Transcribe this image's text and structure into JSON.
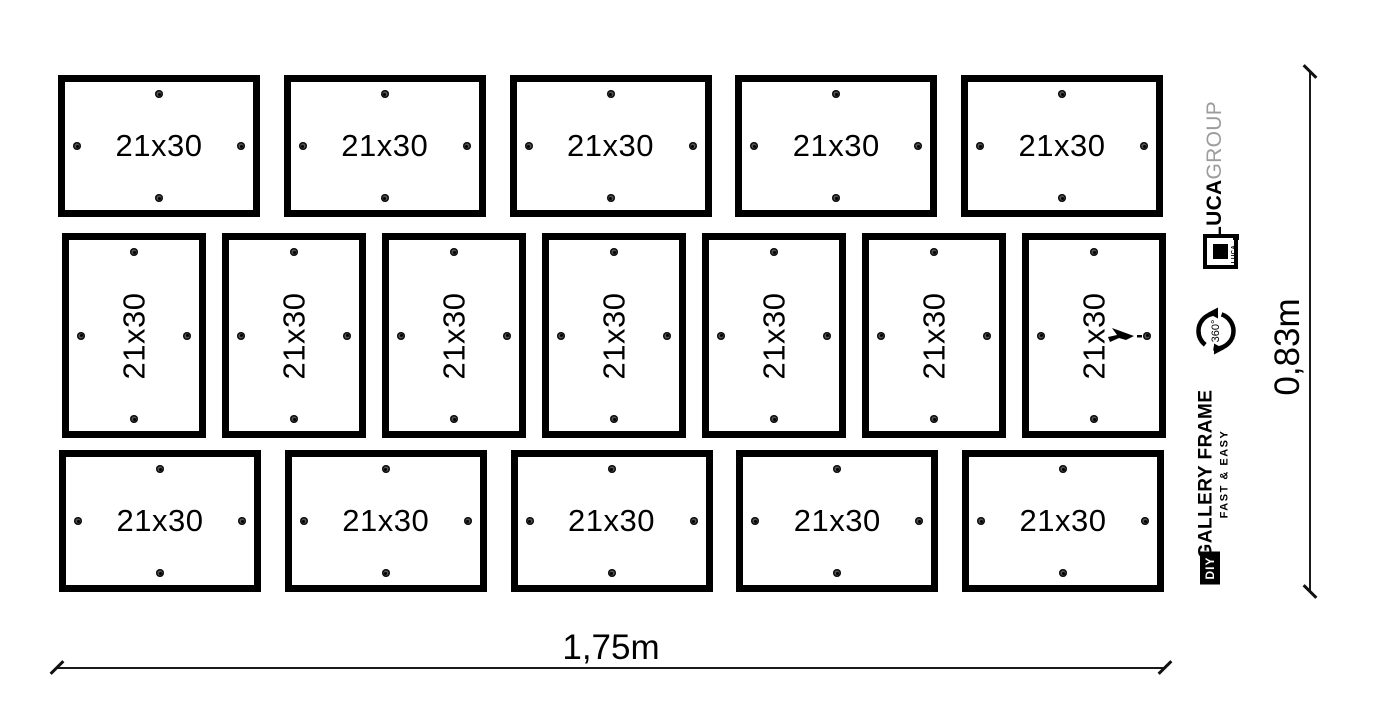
{
  "diagram": {
    "frame_label": "21x30",
    "rows": [
      {
        "name": "top-row",
        "orientation": "landscape",
        "count": 5
      },
      {
        "name": "middle-row",
        "orientation": "portrait",
        "count": 7
      },
      {
        "name": "bottom-row",
        "orientation": "landscape",
        "count": 5
      }
    ],
    "cursor": {
      "row": 1,
      "frame": 6
    }
  },
  "dimensions": {
    "width_label": "1,75m",
    "height_label": "0,83m"
  },
  "branding": {
    "brand_bold": "LUCA",
    "brand_light": "GROUP",
    "brand_light_color": "#9c9c9c",
    "logo_caption": "LUCA",
    "rotation_label": "360°",
    "product_name": "GALLERY FRAME",
    "tagline": "FAST & EASY",
    "diy_label": "DIY"
  },
  "colors": {
    "background": "#ffffff",
    "ink": "#000000"
  }
}
